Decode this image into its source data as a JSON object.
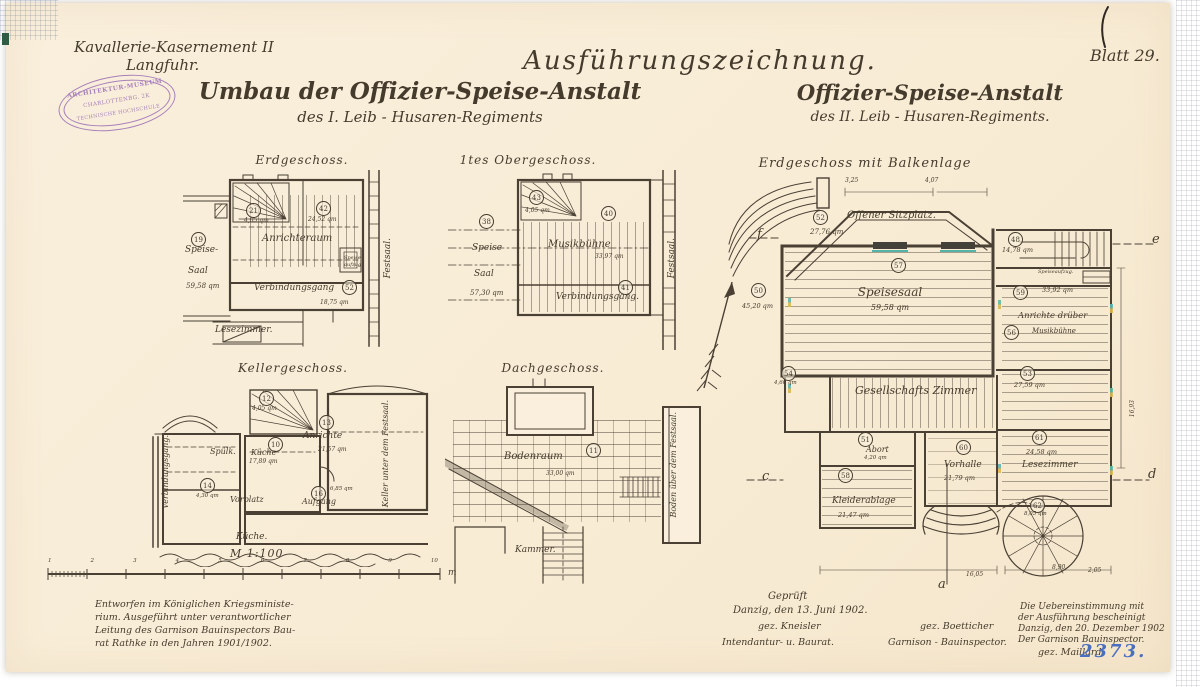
{
  "page": {
    "project": {
      "line1": "Kavallerie-Kasernement II",
      "line2": "Langfuhr."
    },
    "heading": "Ausführungszeichnung.",
    "title_left": {
      "line1": "Umbau der Offizier-Speise-Anstalt",
      "line2": "des I.  Leib - Husaren-Regiments"
    },
    "title_right": {
      "line1": "Offizier-Speise-Anstalt",
      "line2": "des II.  Leib - Husaren-Regiments."
    },
    "sheet_no": "Blatt 29.",
    "archive_no": "2373.",
    "stamp": {
      "line1": "ARCHITEKTUR-MUSEUM",
      "line2": "CHARLOTTENBG. 2K",
      "line3": "TECHNISCHE HOCHSCHULE"
    }
  },
  "plans": {
    "p1": {
      "title": "Erdgeschoss.",
      "saal_ref": "19",
      "saal1": "Speise-",
      "saal2": "Saal",
      "saal_area": "59,58 qm",
      "stair_ref": "21",
      "stair_area": "4,05 qm",
      "anrichteraum": "Anrichteraum",
      "anr_ref": "42",
      "anr_area": "24,52 qm",
      "aufzug1": "Speise-",
      "aufzug2": "aufzug",
      "gang": "Verbindungsgang",
      "gang_ref": "52",
      "gang_area": "18,75 qm",
      "lesezimmer": "Lesezimmer.",
      "festsaal": "Festsaal."
    },
    "p2": {
      "title": "1tes Obergeschoss.",
      "saal_ref": "38",
      "saal1": "Speise",
      "saal2": "Saal",
      "saal_area": "57,30 qm",
      "stair_ref": "43",
      "stair_area": "4,05 qm",
      "musik": "Musikbühne",
      "musik_ref": "40",
      "musik_area": "33,97 qm",
      "gang": "Verbindungsgang.",
      "gang_ref": "41",
      "festsaal": "Festsaal."
    },
    "p3": {
      "title": "Kellergeschoss.",
      "stair_ref": "12",
      "stair_area": "4,05 qm",
      "spuelkueche": "Spülk.",
      "kueche": "Küche",
      "kueche_ref": "10",
      "kueche_area": "17,89 qm",
      "anrichte": "Anrichte",
      "anr_ref": "13",
      "anr_area": "21,57 qm",
      "vorplatz": "Vorplatz",
      "vorplatz_ref": "14",
      "vorplatz_area": "4,30 qm",
      "aufgang": "Aufgang",
      "aufgang_ref": "16",
      "aufgang_area": "6,85 qm",
      "verbindungsgang": "Verbindungsgang.",
      "keller": "Keller unter dem Festsaal.",
      "kueche_unten": "Küche."
    },
    "p4": {
      "title": "Dachgeschoss.",
      "boden": "Bodenraum",
      "boden_ref": "11",
      "boden_area": "33,00 qm",
      "kammer": "Kammer.",
      "festsaal_boden": "Boden über dem Festsaal."
    },
    "p5": {
      "title": "Erdgeschoss mit Balkenlage",
      "sitz_ref": "52",
      "sitzplatz": "Offener Sitzplatz.",
      "sitz_area": "27,76 qm",
      "links_ref": "50",
      "links_area": "45,20 qm",
      "saal_ref": "57",
      "speisesaal": "Speisesaal",
      "saal_area": "59,58 qm",
      "stair_ref": "48",
      "stair_area": "14,78 qm",
      "aufzug": "Speiseaufzug.",
      "anr_ref": "59",
      "anr_area": "33,92 qm",
      "anrichte": "Anrichte drüber",
      "musik_ref": "56",
      "musik": "Musikbühne",
      "ges_ref": "53",
      "ges_area": "27,59 qm",
      "gesellschaft": "Gesellschafts Zimmer",
      "klein_ref": "54",
      "klein_area": "4,60 qm",
      "abort_ref": "51",
      "abort": "Abort",
      "abort_area": "4,20 qm",
      "kleider_ref": "58",
      "kleiderablage": "Kleiderablage",
      "kleider_area": "21,47 qm",
      "vorhalle_ref": "60",
      "vorhalle": "Vorhalle",
      "vorhalle_area": "21,79 qm",
      "lese_ref": "61",
      "lesezimmer": "Lesezimmer",
      "lese_area": "24,58 qm",
      "wendel_ref": "62",
      "wendel_area": "8,05 qm",
      "sec_a": "a",
      "sec_c": "c",
      "sec_d": "d",
      "sec_e": "e",
      "sec_f": "f",
      "dims": [
        "3,25",
        "4,07",
        "16,05",
        "8,90",
        "2,05",
        "16,93"
      ]
    }
  },
  "scale_bar": {
    "label": "M 1:100",
    "unit": "m",
    "ticks": [
      "1",
      "2",
      "3",
      "4",
      "5",
      "6",
      "7",
      "8",
      "9",
      "10"
    ]
  },
  "notes": {
    "designed": {
      "l1": "Entworfen im Königlichen Kriegsministe-",
      "l2": "rium.  Ausgeführt unter verantwortlicher",
      "l3": "Leitung des Garnison Bauinspectors Bau-",
      "l4": "rat Rathke in den Jahren 1901/1902."
    },
    "checked": {
      "l1": "Geprüft",
      "l2": "Danzig, den 13. Juni 1902.",
      "sig1": "gez. Kneisler",
      "sig2": "gez. Boetticher",
      "role1": "Intendantur- u. Baurat.",
      "role2": "Garnison - Bauinspector."
    },
    "certified": {
      "l1": "Die Uebereinstimmung mit",
      "l2": "der Ausführung bescheinigt",
      "l3": "Danzig, den 20. Dezember 1902",
      "l4": "Der Garnison Bauinspector.",
      "sig": "gez. Maillard"
    }
  }
}
